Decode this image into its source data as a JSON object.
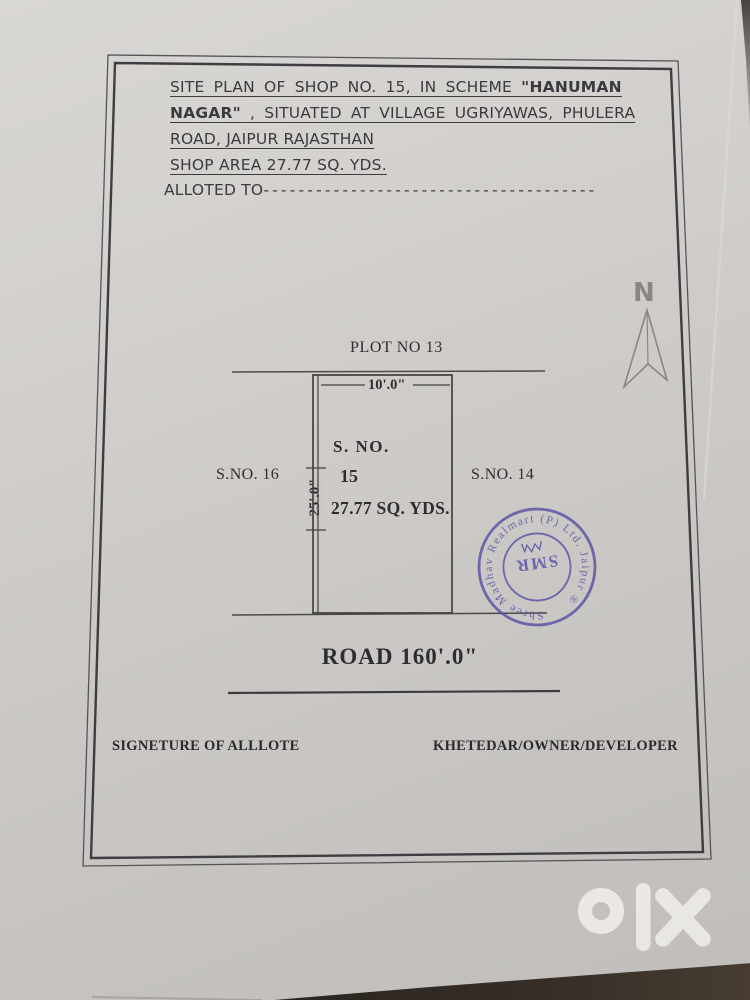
{
  "header": {
    "line1_normal": "SITE PLAN OF SHOP NO. 15, IN SCHEME ",
    "line1_bold": "\"HANUMAN",
    "line2_bold": "NAGAR\"",
    "line2_normal": " ,  SITUATED AT VILLAGE UGRIYAWAS, PHULERA",
    "line3": "ROAD, JAIPUR RAJASTHAN",
    "line4": "SHOP AREA 27.77 SQ. YDS.",
    "line5_label": "ALLOTED TO",
    "line5_dashes": "--------------------------------------"
  },
  "site_plan": {
    "north_label": "N",
    "adjacent_top": "PLOT NO 13",
    "adjacent_left": "S.NO. 16",
    "adjacent_right": "S.NO. 14",
    "plot_line1": "S.  NO.",
    "plot_line2": "15",
    "plot_line3": "27.77 SQ. YDS.",
    "width_dim": "10'.0\"",
    "depth_dim": "25'.0\"",
    "road_label": "ROAD 160'.0\""
  },
  "footer": {
    "left": "SIGNETURE OF ALLLOTE",
    "right": "KHETEDAR/OWNER/DEVELOPER"
  },
  "stamp": {
    "ring_text": "Shree Madhav Realmart (P) Ltd. Jaipur ®",
    "center_text": "SMR",
    "ink_color": "#574ea6"
  },
  "watermark": {
    "brand": "olx"
  },
  "colors": {
    "paper": "#cfccc9",
    "ink": "#38373a",
    "diagram_line": "#454443",
    "north_arrow": "#8a8783",
    "watermark": "#edebe7",
    "table_surface": "#2a241f"
  }
}
